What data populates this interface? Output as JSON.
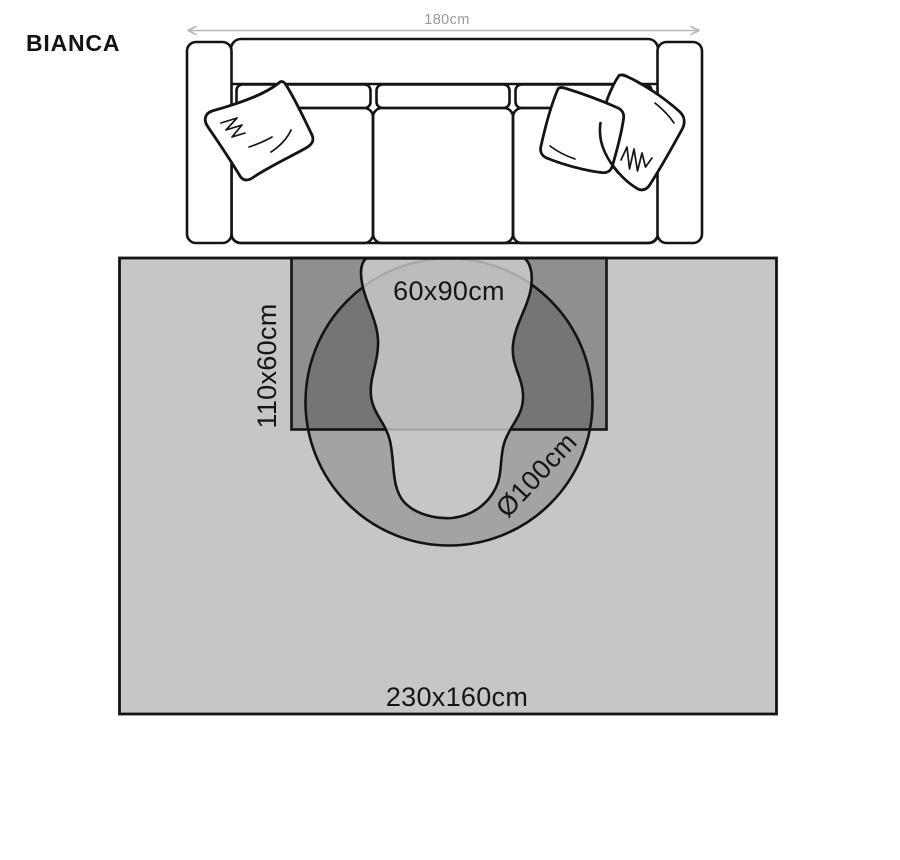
{
  "title": "BIANCA",
  "sofa": {
    "width_label": "180cm"
  },
  "rug_sizes": {
    "small": "60x90cm",
    "runner": "110x60cm",
    "round": "Ø100cm",
    "large": "230x160cm"
  },
  "colors": {
    "rug_base": "#c6c6c6",
    "outline": "#141414",
    "dimension_text": "#9a9a9a"
  }
}
